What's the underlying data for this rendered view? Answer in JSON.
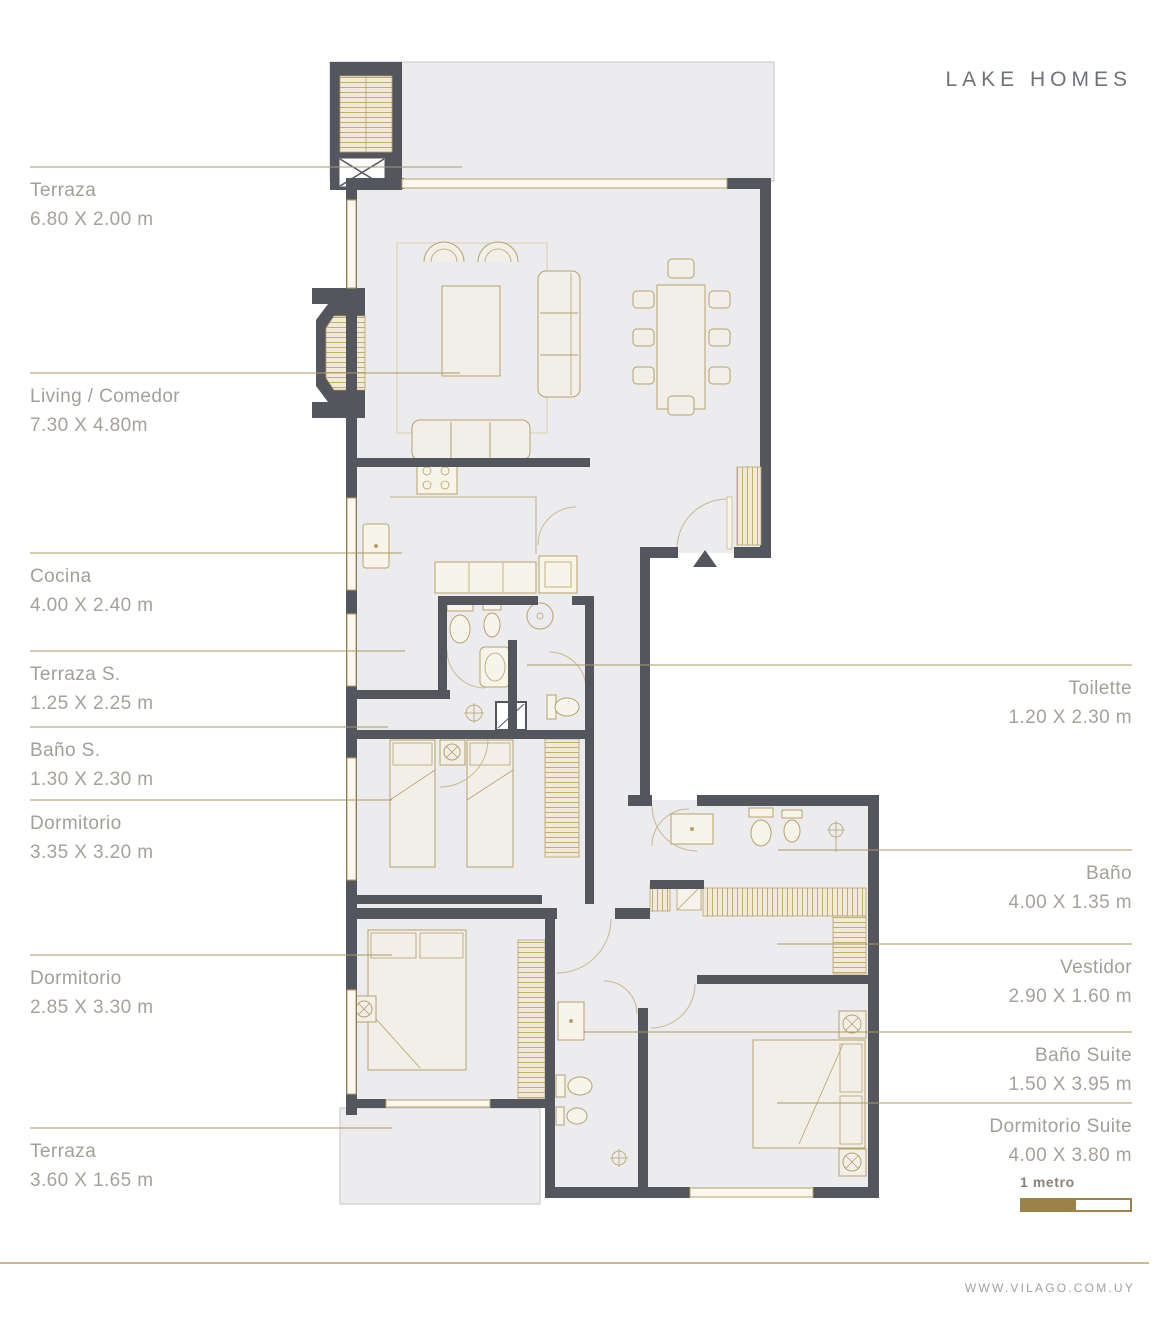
{
  "title": "LAKE HOMES",
  "rooms": {
    "left": [
      {
        "name": "Terraza",
        "dims": "6.80 X 2.00 m"
      },
      {
        "name": "Living / Comedor",
        "dims": "7.30 X 4.80m"
      },
      {
        "name": "Cocina",
        "dims": "4.00 X 2.40 m"
      },
      {
        "name": "Terraza S.",
        "dims": "1.25 X 2.25 m"
      },
      {
        "name": "Baño S.",
        "dims": "1.30 X 2.30 m"
      },
      {
        "name": "Dormitorio",
        "dims": "3.35 X 3.20 m"
      },
      {
        "name": "Dormitorio",
        "dims": "2.85 X 3.30 m"
      },
      {
        "name": "Terraza",
        "dims": "3.60 X 1.65 m"
      }
    ],
    "right": [
      {
        "name": "Toilette",
        "dims": "1.20 X 2.30 m"
      },
      {
        "name": "Baño",
        "dims": "4.00 X 1.35 m"
      },
      {
        "name": "Vestidor",
        "dims": "2.90 X 1.60 m"
      },
      {
        "name": "Baño Suite",
        "dims": "1.50 X 3.95 m"
      },
      {
        "name": "Dormitorio Suite",
        "dims": "4.00 X 3.80 m"
      }
    ]
  },
  "scale": {
    "label": "1 metro"
  },
  "footer": {
    "url": "WWW.VILAGO.COM.UY"
  },
  "colors": {
    "wall": "#54565e",
    "room_fill": "#ecebee",
    "furniture_line": "#b7a26b",
    "accent_gold": "#9c8449",
    "label_text": "#a3a099",
    "title_text": "#6f7378"
  }
}
